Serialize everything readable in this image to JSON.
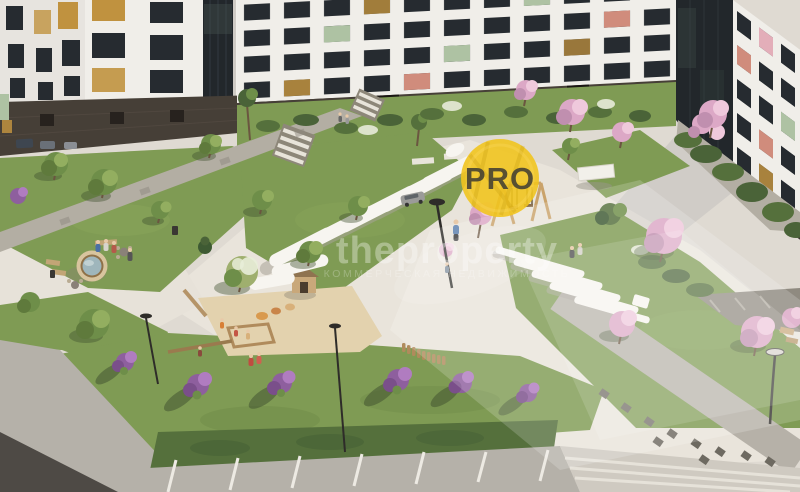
{
  "watermark": {
    "badge_text": "PRO",
    "site_text": "theproperty",
    "subtitle_text": "КОММЕРЧЕСКАЯ НЕДВИЖИМОСТЬ",
    "badge_color": "#F1C41F",
    "badge_text_color": "#3E3C33",
    "text_color": "#FFFFFF"
  },
  "palette": {
    "paveLight": "#DFDAD2",
    "plaza": "#E9E4DB",
    "pathGray": "#B3AEA3",
    "pathDark": "#8F8A80",
    "tileDark": "#6E6A61",
    "lawn": "#7F9B54",
    "hedge": "#55703C",
    "foliage": "#6E8E49",
    "foliageLight": "#93AE60",
    "blossom": "#DCA8C6",
    "blossomLight": "#EFC9DC",
    "blossomDark": "#C08FAF",
    "lilac": "#8E5F9E",
    "lilacLight": "#B07CC0",
    "wallWhite": "#F0EEE9",
    "windowDark": "#262B30",
    "windowLit": "#C0923F",
    "plinth": "#463F37",
    "glassDark": "#22272B",
    "accentGreen": "#AEC2A3",
    "accentCoral": "#D08C7C",
    "accentPink": "#E3AEB9",
    "sand": "#E3D2AE",
    "wood": "#B08B5C",
    "asphalt": "#4E4A45",
    "road": "#B5B1A9",
    "white": "#F7F5F0",
    "badgeYellow": "#F1C41F",
    "badgeText": "#3E3C33",
    "wmWhite": "#FFFFFF"
  }
}
